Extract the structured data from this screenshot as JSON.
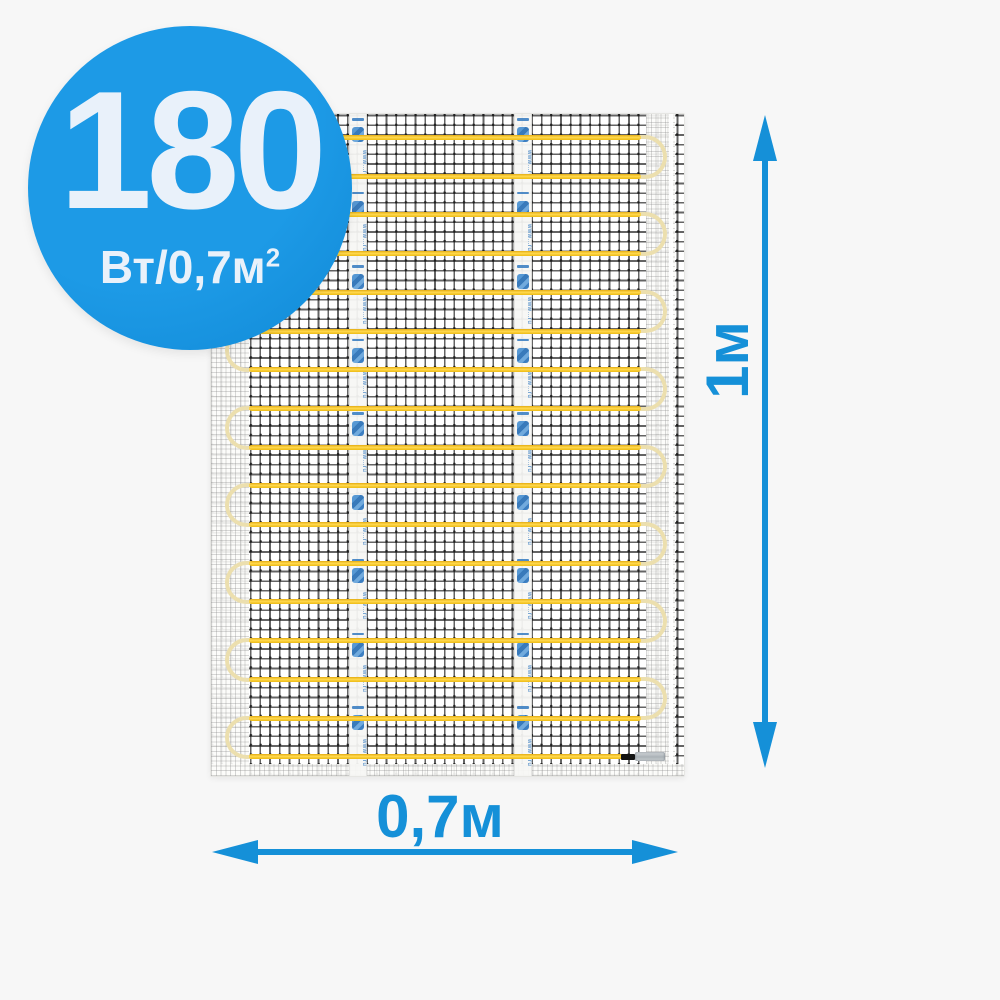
{
  "background_color": "#f7f7f7",
  "badge": {
    "value": "180",
    "unit_base": "Вт/0,7м",
    "unit_sup": "2",
    "bg_color": "#1d9ae6",
    "text_color": "#e9f1fa"
  },
  "dimensions": {
    "height_label": "1м",
    "width_label": "0,7м",
    "color": "#1590d8"
  },
  "product": {
    "name": "heating-mat",
    "mesh_line_color": "#282828",
    "cable_color": "#ffd435",
    "cable_loop_color": "#ecdfae",
    "cable_runs": 17,
    "tape_count": 2,
    "tape_text": "www…ru",
    "tape_text_color": "#3379bf",
    "end_splice": {
      "sleeve_color": "#141414",
      "connector_color": "#b9bfc4"
    }
  }
}
